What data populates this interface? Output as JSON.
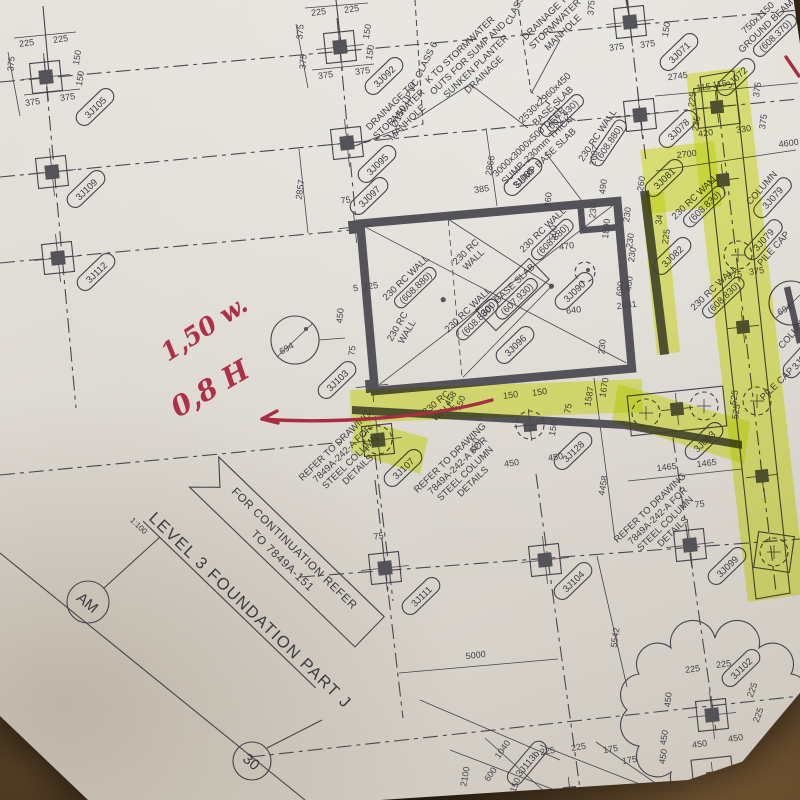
{
  "title_block": {
    "title": "LEVEL 3 FOUNDATION PART J",
    "scale": "1:100",
    "continuation_line1": "FOR CONTINUATION REFER",
    "continuation_line2": "TO 7849A-151",
    "grid_bubble_row": "AM",
    "grid_bubble_col": "30"
  },
  "red_markup": {
    "note_w": "1,50 w.",
    "note_h": "0,8 H"
  },
  "detail_marker": "694",
  "tags": {
    "a": "3J105",
    "b": "3J109",
    "c": "3J112",
    "d": "3J092",
    "e": "3J095",
    "f": "3J097",
    "g": "3J085",
    "h": "3J071",
    "i": "3J078",
    "j": "3J072",
    "k": "3J081",
    "l": "3J082",
    "m": "3J090",
    "n": "3J096",
    "o": "3J103",
    "p": "3J107",
    "q": "3J128",
    "r": "3J111",
    "s": "3J104",
    "t": "3J093",
    "u": "3J099",
    "v": "3J102",
    "w": "3J113b",
    "x": "3J08"
  },
  "notes": {
    "outlets": [
      "K TO STORMWATER",
      "OUTS FOR SUMP AND",
      "SUNKEN PLANTER",
      "DRAINAGE"
    ],
    "manhole": [
      "DRAINAGE TO",
      "STORMWATER",
      "MANHOLE"
    ],
    "pipe": "Ø150 UPVC CLASS 6",
    "pipe_class": "CLASS 6",
    "base_slab": [
      "2530x2960x450",
      "BASE SLAB",
      "(607.430)"
    ],
    "deep_sump": [
      "3000x3000x500 DEEP",
      "SUMP. 230mm THICK",
      "SUMP BASE SLAB"
    ],
    "ground_beam": [
      "750x1150",
      "GROUND BEAM",
      "(608.370)"
    ],
    "column_3j079": [
      "COLUMN",
      "3J079"
    ],
    "pilecap_3j079": [
      "3J079",
      "PILE CAP"
    ],
    "pile_cap": "PILE CAP",
    "column_word": "COLUMN",
    "rc_wall": "230 RC WALL",
    "rc_wall_l1": "230 RC",
    "rc_wall_l2": "WALL",
    "lvl_880": "(608.880)",
    "lvl_830": "(608.830)",
    "base300": [
      "300 BASE SLAB",
      "(607.930)"
    ],
    "refer": [
      "REFER TO DRAWING",
      "7849A-242-A FOR",
      "STEEL COLUMN",
      "DETAILS"
    ]
  },
  "dims": {
    "nw": [
      "225",
      "225",
      "150",
      "150",
      "375",
      "375",
      "375"
    ],
    "n1": [
      "225",
      "225",
      "375",
      "150",
      "150",
      "375",
      "375",
      "375"
    ],
    "n2": [
      "375",
      "375",
      "375",
      "150",
      "2745",
      "2700"
    ],
    "strip": [
      "115",
      "115",
      "225",
      "225",
      "375",
      "375",
      "420",
      "330",
      "4600",
      "375",
      "375",
      "525",
      "525"
    ],
    "mid": [
      "34",
      "225",
      "230",
      "230",
      "230",
      "490",
      "260",
      "1800",
      "230",
      "500",
      "470",
      "260",
      "2607",
      "690",
      "460",
      "2031",
      "640",
      "230"
    ],
    "west": [
      "2857",
      "2866",
      "385",
      "75",
      "5",
      "225",
      "450",
      "75"
    ],
    "wall": [
      "458",
      "150",
      "150",
      "150",
      "150",
      "75",
      "450",
      "450",
      "450",
      "1587",
      "1670",
      "4458"
    ],
    "pc": [
      "1465",
      "1465",
      "75"
    ],
    "low": [
      "75",
      "5000",
      "5542"
    ],
    "cloud": [
      "225",
      "225",
      "450",
      "450",
      "450",
      "225",
      "225",
      "175",
      "175"
    ],
    "edge": [
      "2100",
      "1040",
      "600",
      "150",
      "225",
      "225",
      "450",
      "450"
    ]
  }
}
